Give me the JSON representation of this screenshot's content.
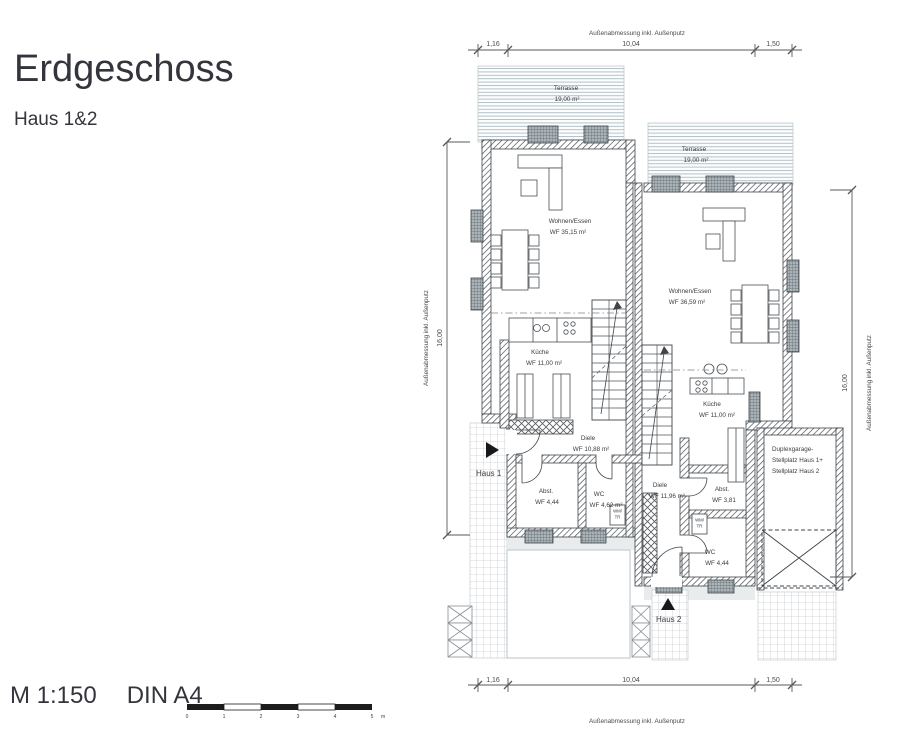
{
  "header": {
    "title": "Erdgeschoss",
    "subtitle": "Haus 1&2"
  },
  "footer": {
    "scale": "M 1:150",
    "format": "DIN A4",
    "scalebar": {
      "ticks": [
        "0",
        "1",
        "2",
        "3",
        "4",
        "5"
      ],
      "unit": "m"
    }
  },
  "dimensions": {
    "top": {
      "label": "Außenabmessung inkl. Außenputz",
      "seg1": "1,16",
      "seg2": "10,04",
      "seg3": "1,50"
    },
    "bottom": {
      "label": "Außenabmessung inkl. Außenputz",
      "seg1": "1,16",
      "seg2": "10,04",
      "seg3": "1,50"
    },
    "left": {
      "label": "Außenabmessung inkl. Außenputz",
      "value": "16,00"
    },
    "right": {
      "label": "Außenabmessung inkl. Außenputz",
      "value": "16,00"
    }
  },
  "haus1": {
    "entrance_label": "Haus 1",
    "terrasse": {
      "name": "Terrasse",
      "area": "19,00 m²"
    },
    "wohnen": {
      "name": "Wohnen/Essen",
      "area": "WF 35,15 m²"
    },
    "kueche": {
      "name": "Küche",
      "area": "WF 11,00 m²"
    },
    "diele": {
      "name": "Diele",
      "area": "WF 10,88 m²"
    },
    "abstell": {
      "name": "Abst.",
      "area": "WF 4,44"
    },
    "wc": {
      "name": "WC",
      "area": "WF 4,62 m²"
    },
    "wm": "WM/",
    "tr": "TR"
  },
  "haus2": {
    "entrance_label": "Haus 2",
    "terrasse": {
      "name": "Terrasse",
      "area": "19,00 m²"
    },
    "wohnen": {
      "name": "Wohnen/Essen",
      "area": "WF 36,59 m²"
    },
    "kueche": {
      "name": "Küche",
      "area": "WF 11,00 m²"
    },
    "diele": {
      "name": "Diele",
      "area": "WF 11,96 m²"
    },
    "abstell": {
      "name": "Abst.",
      "area": "WF 3,81"
    },
    "wc": {
      "name": "WC",
      "area": "WF 4,44"
    },
    "wm": "WM/",
    "tr": "TR"
  },
  "garage": {
    "line1": "Duplexgarage-",
    "line2": "Stellplatz Haus 1+",
    "line3": "Stellplatz Haus 2"
  },
  "colors": {
    "ink": "#3f454a",
    "terrace_hatch": "#b4c2c8",
    "grid_hatch": "#c6ccd0",
    "window_fill": "#aab3b7",
    "band": "#e8ecec"
  }
}
